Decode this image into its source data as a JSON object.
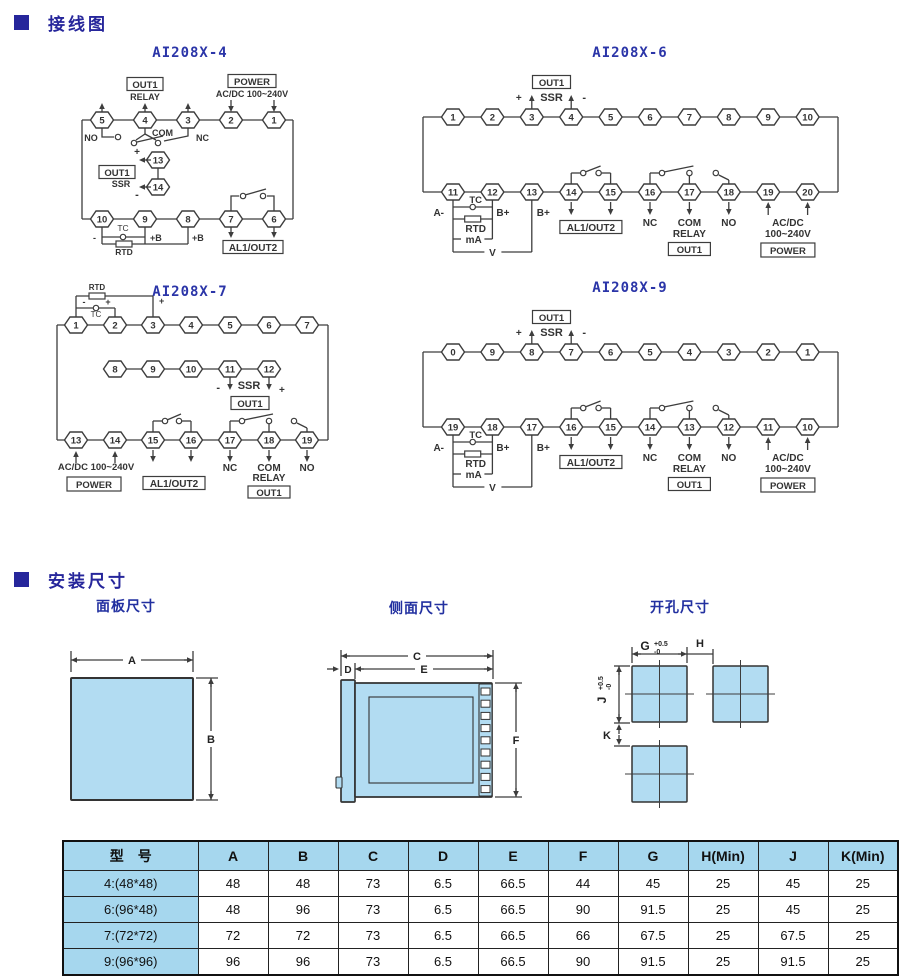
{
  "colors": {
    "header_blue": "#26269b",
    "title_blue": "#2b35a8",
    "line": "#3d3d3d",
    "panel_fill": "#b2dcf2",
    "table_header_bg": "#a6d7ee"
  },
  "sections": {
    "wiring": {
      "title": "接线图"
    },
    "mounting": {
      "title": "安装尺寸"
    }
  },
  "wiring": {
    "diagrams": {
      "d4": {
        "title": "AI208X-4",
        "top_terminals": [
          "5",
          "4",
          "3",
          "2",
          "1"
        ],
        "bottom_terminals": [
          "10",
          "9",
          "8",
          "7",
          "6"
        ],
        "ssr_terminals": [
          "13",
          "14"
        ],
        "labels": {
          "out1_relay_box": "OUT1",
          "relay": "RELAY",
          "power_box": "POWER",
          "acdc": "AC/DC 100~240V",
          "no": "NO",
          "com": "COM",
          "nc": "NC",
          "ssr_plus": "+",
          "ssr_minus": "-",
          "out1_ssr_box": "OUT1",
          "ssr": "SSR",
          "tc": "TC",
          "rtd": "RTD",
          "minus": "-",
          "plus_b1": "+B",
          "plus_b2": "+B",
          "al1out2_box": "AL1/OUT2"
        }
      },
      "d6": {
        "title": "AI208X-6",
        "top_terminals": [
          "1",
          "2",
          "3",
          "4",
          "5",
          "6",
          "7",
          "8",
          "9",
          "10"
        ],
        "bottom_terminals": [
          "11",
          "12",
          "13",
          "14",
          "15",
          "16",
          "17",
          "18",
          "19",
          "20"
        ],
        "labels": {
          "out1_ssr_box": "OUT1",
          "ssr": "SSR",
          "ssr_plus": "+",
          "ssr_minus": "-",
          "tc": "TC",
          "a_minus": "A-",
          "b_plus1": "B+",
          "b_plus2": "B+",
          "rtd": "RTD",
          "ma": "mA",
          "v": "V",
          "al1out2_box": "AL1/OUT2",
          "nc": "NC",
          "com": "COM",
          "relay": "RELAY",
          "out1_relay_box": "OUT1",
          "no": "NO",
          "acdc1": "AC/DC",
          "acdc2": "100~240V",
          "power_box": "POWER"
        }
      },
      "d7": {
        "title": "AI208X-7",
        "top_terminals": [
          "1",
          "2",
          "3",
          "4",
          "5",
          "6",
          "7"
        ],
        "middle_terminals": [
          "8",
          "9",
          "10",
          "11",
          "12"
        ],
        "bottom_terminals": [
          "13",
          "14",
          "15",
          "16",
          "17",
          "18",
          "19"
        ],
        "labels": {
          "rtd": "RTD",
          "tc": "TC",
          "tc_minus": "-",
          "tc_plus": "+",
          "rtd_plus": "+",
          "ssr_minus": "-",
          "ssr": "SSR",
          "ssr_plus": "+",
          "out1_ssr_box": "OUT1",
          "acdc": "AC/DC 100~240V",
          "power_box": "POWER",
          "al1out2_box": "AL1/OUT2",
          "nc": "NC",
          "com": "COM",
          "relay": "RELAY",
          "out1_relay_box": "OUT1",
          "no": "NO"
        }
      },
      "d9": {
        "title": "AI208X-9",
        "top_terminals": [
          "0",
          "9",
          "8",
          "7",
          "6",
          "5",
          "4",
          "3",
          "2",
          "1"
        ],
        "bottom_terminals": [
          "19",
          "18",
          "17",
          "16",
          "15",
          "14",
          "13",
          "12",
          "11",
          "10"
        ],
        "labels": {
          "out1_ssr_box": "OUT1",
          "ssr": "SSR",
          "ssr_plus": "+",
          "ssr_minus": "-",
          "tc": "TC",
          "a_minus": "A-",
          "b_plus1": "B+",
          "b_plus2": "B+",
          "rtd": "RTD",
          "ma": "mA",
          "v": "V",
          "al1out2_box": "AL1/OUT2",
          "nc": "NC",
          "com": "COM",
          "relay": "RELAY",
          "out1_relay_box": "OUT1",
          "no": "NO",
          "acdc1": "AC/DC",
          "acdc2": "100~240V",
          "power_box": "POWER"
        }
      }
    }
  },
  "mounting": {
    "panel": {
      "title": "面板尺寸",
      "dims": {
        "a": "A",
        "b": "B"
      }
    },
    "side": {
      "title": "侧面尺寸",
      "dims": {
        "c": "C",
        "d": "D",
        "e": "E",
        "f": "F"
      }
    },
    "cutout": {
      "title": "开孔尺寸",
      "dims": {
        "g": "G",
        "g_tol_top": "+0.5",
        "g_tol_bot": "-0",
        "h": "H",
        "j": "J",
        "j_tol_top": "+0.5",
        "j_tol_bot": "-0",
        "k": "K"
      }
    }
  },
  "table": {
    "headers": [
      "型　号",
      "A",
      "B",
      "C",
      "D",
      "E",
      "F",
      "G",
      "H(Min)",
      "J",
      "K(Min)"
    ],
    "rows": [
      [
        "4:(48*48)",
        "48",
        "48",
        "73",
        "6.5",
        "66.5",
        "44",
        "45",
        "25",
        "45",
        "25"
      ],
      [
        "6:(96*48)",
        "48",
        "96",
        "73",
        "6.5",
        "66.5",
        "90",
        "91.5",
        "25",
        "45",
        "25"
      ],
      [
        "7:(72*72)",
        "72",
        "72",
        "73",
        "6.5",
        "66.5",
        "66",
        "67.5",
        "25",
        "67.5",
        "25"
      ],
      [
        "9:(96*96)",
        "96",
        "96",
        "73",
        "6.5",
        "66.5",
        "90",
        "91.5",
        "25",
        "91.5",
        "25"
      ]
    ]
  }
}
